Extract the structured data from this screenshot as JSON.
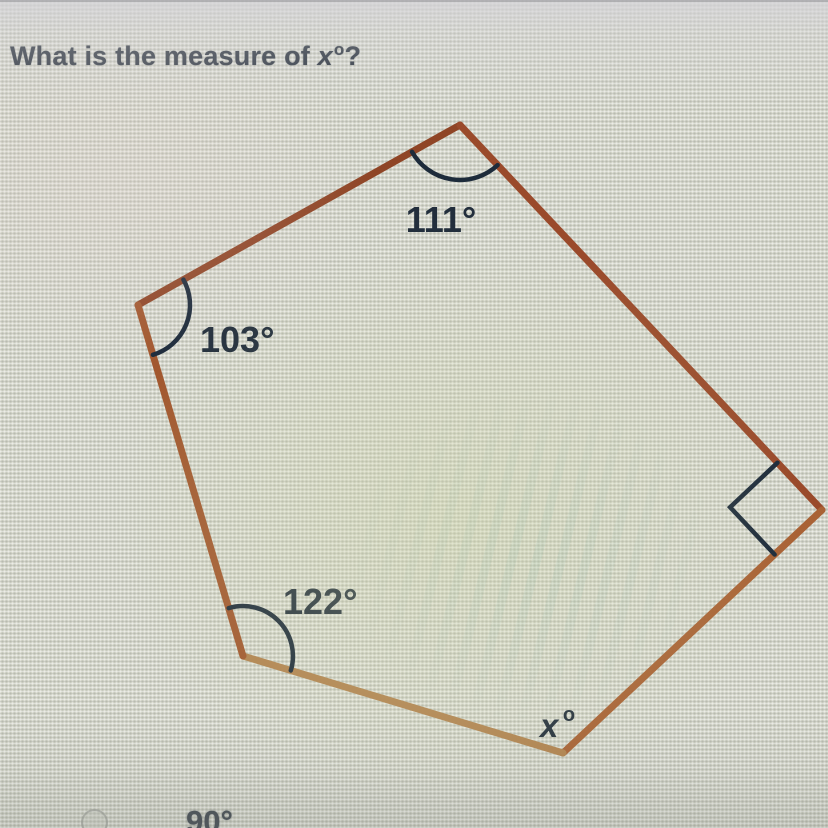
{
  "page": {
    "background": "#d2d4c8",
    "ink": "#222e3c",
    "edge_color": "#9a4a2b"
  },
  "question": {
    "prefix": "What is the measure of ",
    "variable": "x",
    "superscript": "o",
    "suffix": "?"
  },
  "diagram": {
    "shape": "irregular pentagon",
    "angles": {
      "top": {
        "label": "111°"
      },
      "left": {
        "label": "103°"
      },
      "bottom_left": {
        "label": "122°"
      },
      "right": {
        "marker": "right-angle-square"
      },
      "bottom": {
        "variable": "x",
        "superscript": "o"
      }
    }
  },
  "answers": [
    {
      "label": "90°",
      "selected": false
    }
  ]
}
